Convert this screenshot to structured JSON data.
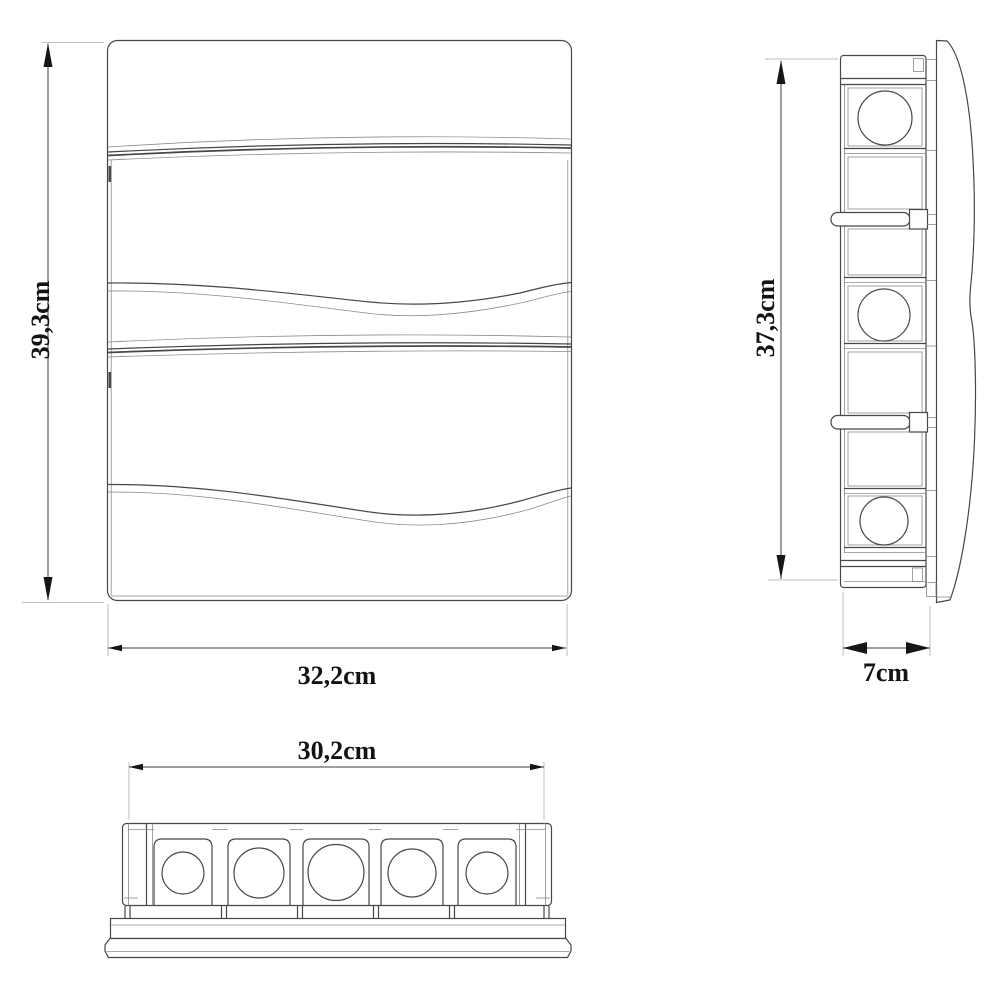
{
  "drawing": {
    "title": "enclosure-three-view-dimension-drawing",
    "views": {
      "front": {
        "height_label": "39,3cm",
        "width_label": "32,2cm"
      },
      "side": {
        "height_label": "37,3cm",
        "depth_label": "7cm"
      },
      "bottom": {
        "width_label": "30,2cm"
      }
    },
    "colors": {
      "background": "#ffffff",
      "outline": "#474747",
      "light_line": "#8a8a8a",
      "extension_line": "#bdbdbd",
      "dimension": "#161616"
    }
  }
}
